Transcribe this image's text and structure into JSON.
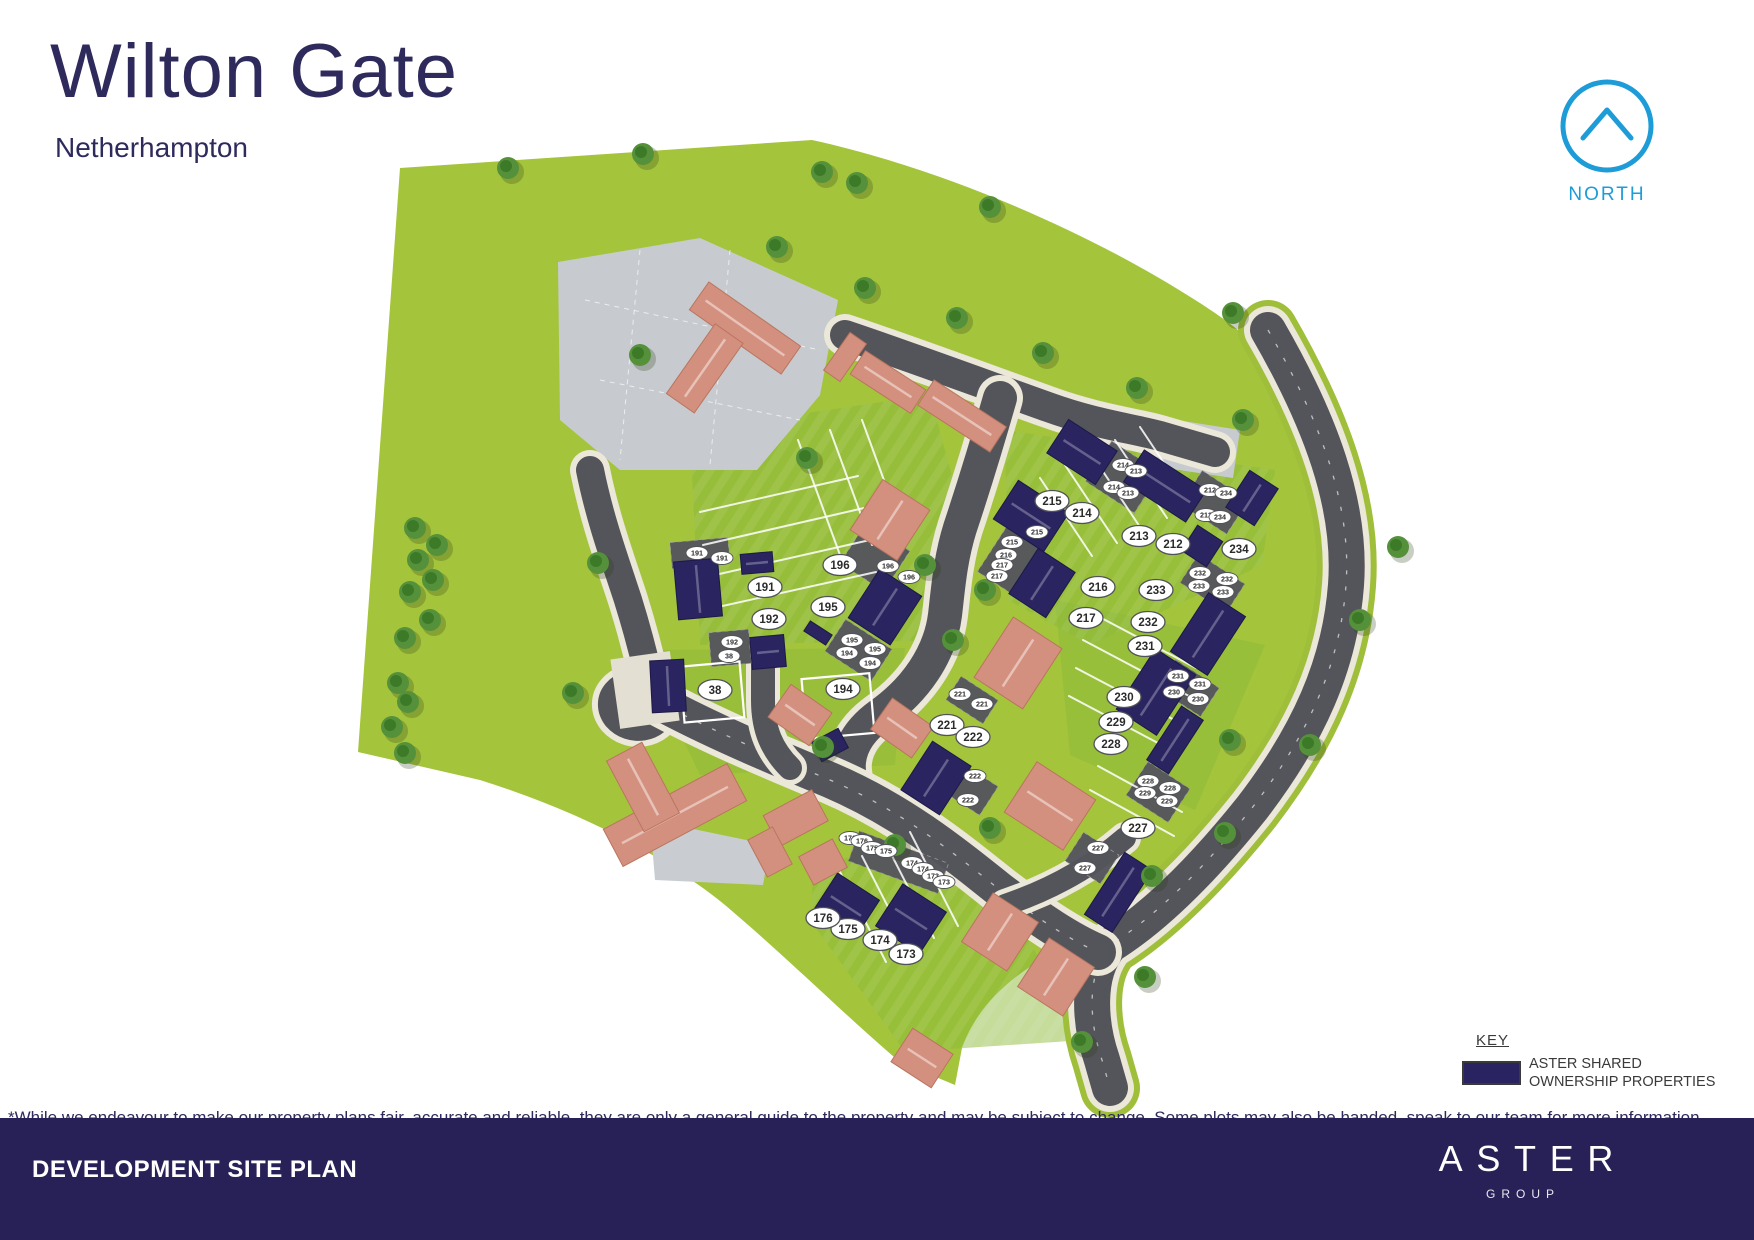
{
  "header": {
    "title": "Wilton Gate",
    "subtitle": "Netherhampton"
  },
  "north": {
    "label": "NORTH",
    "color": "#1e9cd8"
  },
  "key": {
    "title": "KEY",
    "swatch_color": "#2a2361",
    "label_line1": "ASTER SHARED",
    "label_line2": "OWNERSHIP PROPERTIES"
  },
  "disclaimer": "*While we endeavour to make our property plans fair, accurate and reliable, they are only a general guide to the property and may be subject to change. Some plots may also be handed, speak to our team for more information.",
  "footer": {
    "left_title": "DEVELOPMENT SITE PLAN",
    "brand_name": "ASTER",
    "brand_sub": "GROUP",
    "bar_color": "#282157"
  },
  "map": {
    "colors": {
      "field": "#a4c43c",
      "lawn": "#8cba38",
      "road": "#54555a",
      "sidewalk": "#ebe7d9",
      "courtyard": "#c7cbcf",
      "shared_ownership_house": "#2a2460",
      "private_house": "#d4907e",
      "tree": "#55913a"
    },
    "plot_labels_large": [
      {
        "n": "38",
        "x": 715,
        "y": 690
      },
      {
        "n": "191",
        "x": 765,
        "y": 587
      },
      {
        "n": "192",
        "x": 769,
        "y": 619
      },
      {
        "n": "194",
        "x": 843,
        "y": 689
      },
      {
        "n": "195",
        "x": 828,
        "y": 607
      },
      {
        "n": "196",
        "x": 840,
        "y": 565
      },
      {
        "n": "173",
        "x": 906,
        "y": 954
      },
      {
        "n": "174",
        "x": 880,
        "y": 940
      },
      {
        "n": "175",
        "x": 848,
        "y": 929
      },
      {
        "n": "176",
        "x": 823,
        "y": 918
      },
      {
        "n": "212",
        "x": 1173,
        "y": 544
      },
      {
        "n": "213",
        "x": 1139,
        "y": 536
      },
      {
        "n": "214",
        "x": 1082,
        "y": 513
      },
      {
        "n": "215",
        "x": 1052,
        "y": 501
      },
      {
        "n": "216",
        "x": 1098,
        "y": 587
      },
      {
        "n": "217",
        "x": 1086,
        "y": 618
      },
      {
        "n": "221",
        "x": 947,
        "y": 725
      },
      {
        "n": "222",
        "x": 973,
        "y": 737
      },
      {
        "n": "227",
        "x": 1138,
        "y": 828
      },
      {
        "n": "228",
        "x": 1111,
        "y": 744
      },
      {
        "n": "229",
        "x": 1116,
        "y": 722
      },
      {
        "n": "230",
        "x": 1124,
        "y": 697
      },
      {
        "n": "231",
        "x": 1145,
        "y": 646
      },
      {
        "n": "232",
        "x": 1148,
        "y": 622
      },
      {
        "n": "233",
        "x": 1156,
        "y": 590
      },
      {
        "n": "234",
        "x": 1239,
        "y": 549
      }
    ],
    "plot_labels_small": [
      {
        "n": "191",
        "x": 697,
        "y": 553
      },
      {
        "n": "191",
        "x": 722,
        "y": 558
      },
      {
        "n": "192",
        "x": 732,
        "y": 642
      },
      {
        "n": "38",
        "x": 729,
        "y": 656
      },
      {
        "n": "196",
        "x": 888,
        "y": 566
      },
      {
        "n": "196",
        "x": 909,
        "y": 577
      },
      {
        "n": "195",
        "x": 852,
        "y": 640
      },
      {
        "n": "194",
        "x": 847,
        "y": 653
      },
      {
        "n": "195",
        "x": 875,
        "y": 649
      },
      {
        "n": "194",
        "x": 870,
        "y": 663
      },
      {
        "n": "215",
        "x": 1037,
        "y": 532
      },
      {
        "n": "215",
        "x": 1012,
        "y": 542
      },
      {
        "n": "216",
        "x": 1006,
        "y": 555
      },
      {
        "n": "217",
        "x": 1002,
        "y": 565
      },
      {
        "n": "217",
        "x": 997,
        "y": 576
      },
      {
        "n": "214",
        "x": 1123,
        "y": 465
      },
      {
        "n": "213",
        "x": 1136,
        "y": 471
      },
      {
        "n": "214",
        "x": 1114,
        "y": 487
      },
      {
        "n": "213",
        "x": 1128,
        "y": 493
      },
      {
        "n": "212",
        "x": 1210,
        "y": 490
      },
      {
        "n": "234",
        "x": 1226,
        "y": 493
      },
      {
        "n": "212",
        "x": 1206,
        "y": 515
      },
      {
        "n": "234",
        "x": 1220,
        "y": 517
      },
      {
        "n": "232",
        "x": 1200,
        "y": 573
      },
      {
        "n": "232",
        "x": 1227,
        "y": 579
      },
      {
        "n": "233",
        "x": 1199,
        "y": 586
      },
      {
        "n": "233",
        "x": 1223,
        "y": 592
      },
      {
        "n": "231",
        "x": 1178,
        "y": 676
      },
      {
        "n": "231",
        "x": 1200,
        "y": 684
      },
      {
        "n": "230",
        "x": 1174,
        "y": 692
      },
      {
        "n": "230",
        "x": 1198,
        "y": 699
      },
      {
        "n": "228",
        "x": 1148,
        "y": 781
      },
      {
        "n": "229",
        "x": 1145,
        "y": 793
      },
      {
        "n": "228",
        "x": 1170,
        "y": 788
      },
      {
        "n": "229",
        "x": 1167,
        "y": 801
      },
      {
        "n": "227",
        "x": 1098,
        "y": 848
      },
      {
        "n": "227",
        "x": 1085,
        "y": 868
      },
      {
        "n": "221",
        "x": 960,
        "y": 694
      },
      {
        "n": "221",
        "x": 982,
        "y": 704
      },
      {
        "n": "222",
        "x": 975,
        "y": 776
      },
      {
        "n": "222",
        "x": 968,
        "y": 800
      },
      {
        "n": "176",
        "x": 850,
        "y": 838
      },
      {
        "n": "176",
        "x": 862,
        "y": 841
      },
      {
        "n": "175",
        "x": 872,
        "y": 848
      },
      {
        "n": "175",
        "x": 886,
        "y": 851
      },
      {
        "n": "174",
        "x": 912,
        "y": 863
      },
      {
        "n": "174",
        "x": 923,
        "y": 869
      },
      {
        "n": "173",
        "x": 933,
        "y": 876
      },
      {
        "n": "173",
        "x": 944,
        "y": 882
      }
    ]
  }
}
